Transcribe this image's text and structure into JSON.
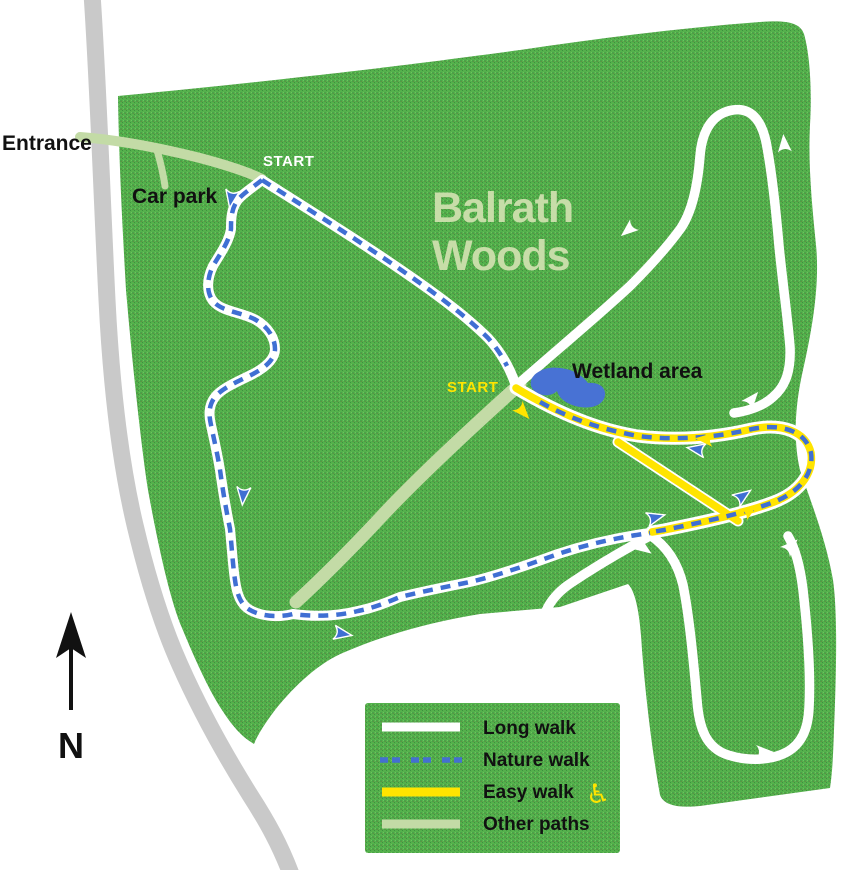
{
  "map": {
    "title_line1": "Balrath",
    "title_line2": "Woods",
    "labels": {
      "entrance": "Entrance",
      "car_park": "Car park",
      "start_long_walk": "START",
      "start_easy_walk": "START",
      "wetland": "Wetland area",
      "north": "N"
    },
    "legend": {
      "items": [
        {
          "label": "Long walk",
          "style": "solid",
          "color": "#ffffff"
        },
        {
          "label": "Nature walk",
          "style": "dashed",
          "color": "#4470d0"
        },
        {
          "label": "Easy walk",
          "style": "solid",
          "color": "#ffe400",
          "icon": "wheelchair"
        },
        {
          "label": "Other paths",
          "style": "solid",
          "color": "#c3dba6"
        }
      ],
      "wheelchair_symbol": "♿"
    },
    "colors": {
      "woodland_green": "#54b04b",
      "path_white": "#ffffff",
      "nature_blue": "#3f6fd3",
      "easy_yellow": "#ffe400",
      "other_path_green": "#c3dba6",
      "road_grey": "#c9c9c9",
      "wetland_blue": "#4872d4",
      "title_green": "#c7dda8"
    }
  }
}
